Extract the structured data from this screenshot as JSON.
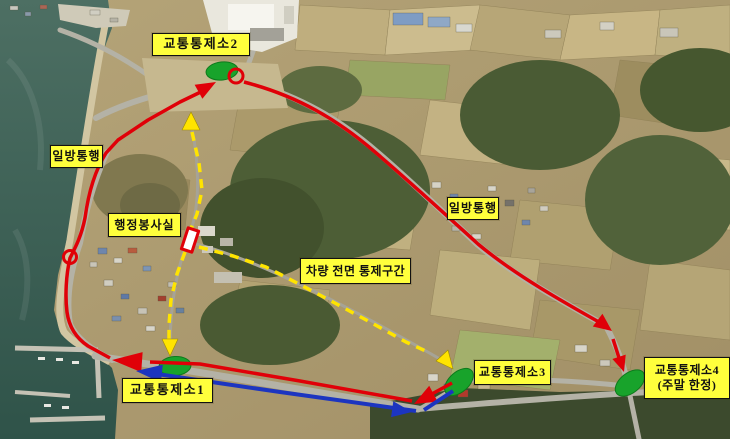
{
  "map": {
    "labels": {
      "post2": "교통통제소2",
      "oneway_left": "일방통행",
      "admin_office": "행정봉사실",
      "control_section": "차량 전면 통제구간",
      "oneway_right": "일방통행",
      "post3": "교통통제소3",
      "post1": "교통통제소1",
      "post4_line1": "교통통제소4",
      "post4_line2": "(주말 한정)"
    },
    "colors": {
      "route_red": "#e00008",
      "route_blue": "#1c35c0",
      "marker_green": "#18a32b",
      "dashed_yellow": "#ffe400",
      "label_bg": "#ffff3c",
      "label_text": "#111111"
    },
    "icons": {
      "green_ellipse": "control-post-location-marker",
      "red_ring": "route-terminus-circle-marker",
      "office_building": "admin-office-building-marker",
      "yellow_triangle": "controlled-route-direction-arrow",
      "red_arrow": "one-way-vehicle-direction-arrow",
      "blue_arrow": "vehicle-direction-arrow"
    }
  }
}
